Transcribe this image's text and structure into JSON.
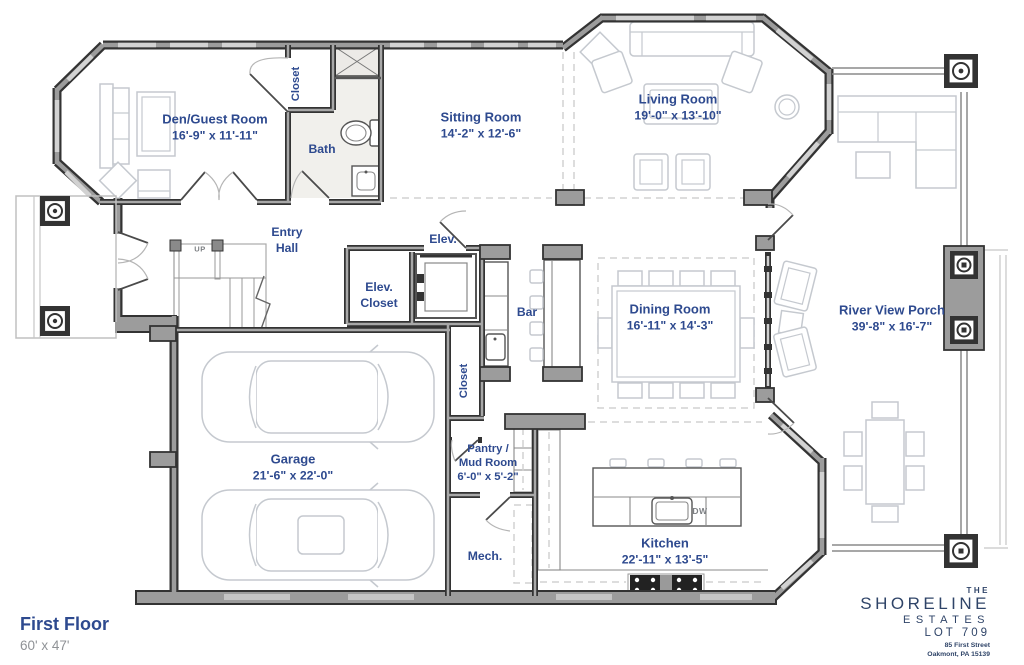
{
  "meta": {
    "title": "First Floor",
    "plan_size": "60' x 47'"
  },
  "brand": {
    "the": "THE",
    "name": "SHORELINE",
    "type": "ESTATES",
    "lot": "LOT 709",
    "address1": "85 First Street",
    "address2": "Oakmont, PA 15139"
  },
  "rooms": {
    "den": {
      "name": "Den/Guest Room",
      "dims": "16'-9\" x 11'-11\""
    },
    "closet_top": {
      "name": "Closet"
    },
    "bath": {
      "name": "Bath"
    },
    "sitting": {
      "name": "Sitting Room",
      "dims": "14'-2\" x 12'-6\""
    },
    "living": {
      "name": "Living Room",
      "dims": "19'-0\" x 13'-10\""
    },
    "entry": {
      "line1": "Entry",
      "line2": "Hall"
    },
    "elev_closet": {
      "line1": "Elev.",
      "line2": "Closet"
    },
    "elev": {
      "name": "Elev."
    },
    "bar": {
      "name": "Bar"
    },
    "closet_mid": {
      "name": "Closet"
    },
    "dining": {
      "name": "Dining Room",
      "dims": "16'-11\" x 14'-3\""
    },
    "porch": {
      "name": "River View Porch",
      "dims": "39'-8\" x 16'-7\""
    },
    "garage": {
      "name": "Garage",
      "dims": "21'-6\" x 22'-0\""
    },
    "pantry": {
      "line1": "Pantry /",
      "line2": "Mud Room",
      "dims": "6'-0\" x 5'-2\""
    },
    "mech": {
      "name": "Mech."
    },
    "kitchen": {
      "name": "Kitchen",
      "dims": "22'-11\" x 13'-5\""
    }
  },
  "annotations": {
    "stairs_up": "UP",
    "dishwasher": "DW"
  },
  "colors": {
    "label_navy": "#2e4a8f",
    "brand_navy": "#2f4468",
    "wall_dark": "#333333",
    "wall_fill": "#9c9c9c",
    "furniture_gray": "#c5c9cf",
    "dashed_gray": "#d2d2d2",
    "muted_text": "#8f9296"
  }
}
